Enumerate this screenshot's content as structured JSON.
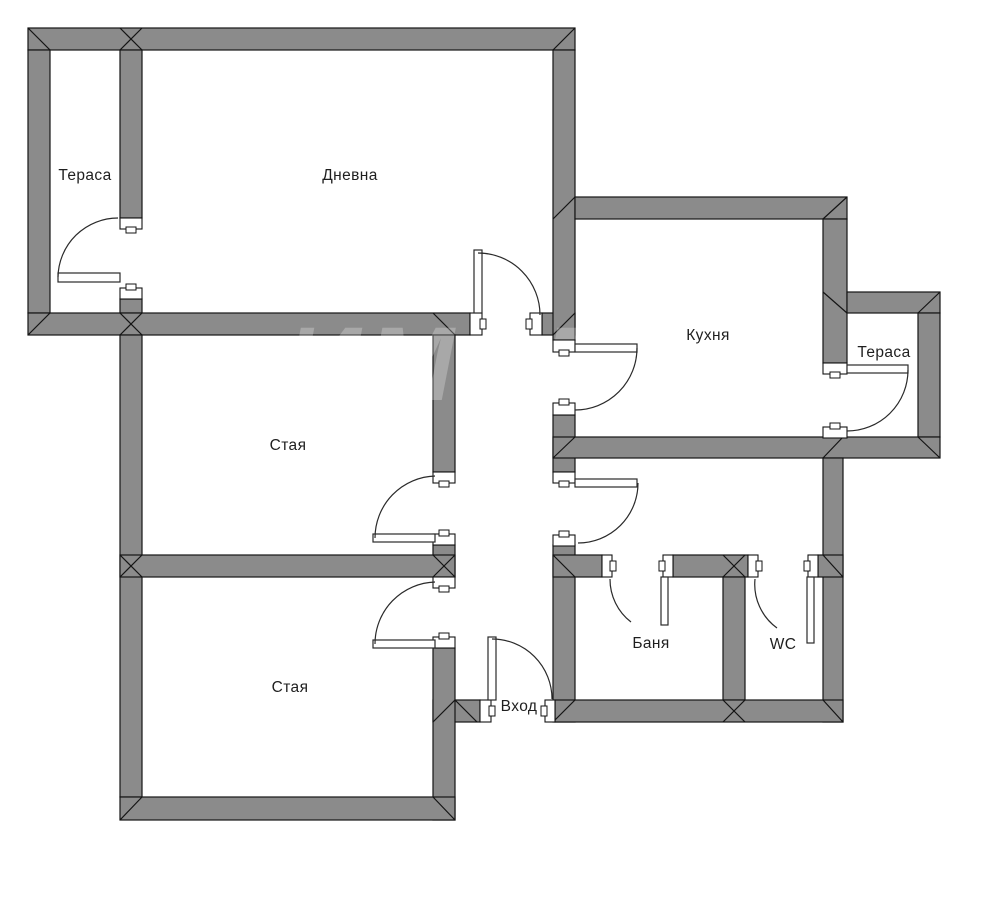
{
  "floorplan": {
    "canvas": {
      "width": 1000,
      "height": 919,
      "background": "#ffffff"
    },
    "colors": {
      "wall_fill": "#8b8b8b",
      "wall_stroke": "#141414",
      "door_stroke": "#2a2a2a",
      "opening_fill": "#ffffff",
      "label_color": "#1f1f1f",
      "watermark_color": "#ffffff"
    },
    "watermark": {
      "text": "ИМОТИ",
      "x": 285,
      "y": 400,
      "font_size": 105,
      "letter_spacing": 6,
      "opacity": 0.25
    },
    "rooms": [
      {
        "id": "terrace-top-left",
        "label": "Тераса",
        "x": 85,
        "y": 180
      },
      {
        "id": "living-room",
        "label": "Дневна",
        "x": 350,
        "y": 180
      },
      {
        "id": "kitchen",
        "label": "Кухня",
        "x": 708,
        "y": 340
      },
      {
        "id": "terrace-right",
        "label": "Тераса",
        "x": 884,
        "y": 357
      },
      {
        "id": "room-middle",
        "label": "Стая",
        "x": 288,
        "y": 450
      },
      {
        "id": "room-bottom",
        "label": "Стая",
        "x": 290,
        "y": 692
      },
      {
        "id": "bathroom",
        "label": "Баня",
        "x": 651,
        "y": 648
      },
      {
        "id": "wc",
        "label": "WC",
        "x": 783,
        "y": 649
      },
      {
        "id": "entrance",
        "label": "Вход",
        "x": 519,
        "y": 711
      }
    ],
    "walls": [
      [
        28,
        28,
        547,
        22
      ],
      [
        28,
        50,
        22,
        263
      ],
      [
        120,
        50,
        22,
        168
      ],
      [
        120,
        299,
        22,
        14
      ],
      [
        28,
        313,
        442,
        22
      ],
      [
        542,
        313,
        33,
        22
      ],
      [
        553,
        50,
        22,
        290
      ],
      [
        553,
        415,
        22,
        57
      ],
      [
        553,
        545,
        22,
        177
      ],
      [
        575,
        197,
        272,
        22
      ],
      [
        823,
        219,
        24,
        144
      ],
      [
        847,
        292,
        93,
        21
      ],
      [
        918,
        313,
        22,
        124
      ],
      [
        553,
        437,
        387,
        21
      ],
      [
        823,
        458,
        20,
        264
      ],
      [
        553,
        555,
        49,
        22
      ],
      [
        673,
        555,
        75,
        22
      ],
      [
        818,
        555,
        25,
        22
      ],
      [
        723,
        577,
        22,
        123
      ],
      [
        555,
        700,
        288,
        22
      ],
      [
        433,
        700,
        47,
        22
      ],
      [
        433,
        335,
        22,
        137
      ],
      [
        433,
        545,
        22,
        32
      ],
      [
        433,
        648,
        22,
        172
      ],
      [
        120,
        335,
        22,
        462
      ],
      [
        120,
        555,
        335,
        22
      ],
      [
        120,
        797,
        335,
        23
      ]
    ],
    "bevels": [
      [
        28,
        28,
        50,
        50
      ],
      [
        120,
        28,
        142,
        50
      ],
      [
        142,
        28,
        120,
        50
      ],
      [
        575,
        28,
        553,
        50
      ],
      [
        28,
        335,
        50,
        313
      ],
      [
        120,
        313,
        142,
        335
      ],
      [
        142,
        313,
        120,
        335
      ],
      [
        553,
        335,
        575,
        313
      ],
      [
        433,
        313,
        455,
        335
      ],
      [
        553,
        219,
        575,
        197
      ],
      [
        847,
        197,
        823,
        219
      ],
      [
        823,
        292,
        847,
        313
      ],
      [
        940,
        292,
        918,
        313
      ],
      [
        940,
        458,
        918,
        437
      ],
      [
        553,
        458,
        575,
        437
      ],
      [
        823,
        458,
        843,
        437
      ],
      [
        823,
        555,
        843,
        577
      ],
      [
        723,
        555,
        745,
        577
      ],
      [
        745,
        555,
        723,
        577
      ],
      [
        723,
        700,
        745,
        722
      ],
      [
        745,
        700,
        723,
        722
      ],
      [
        823,
        700,
        843,
        722
      ],
      [
        553,
        722,
        575,
        700
      ],
      [
        455,
        700,
        433,
        722
      ],
      [
        455,
        700,
        477,
        722
      ],
      [
        120,
        820,
        142,
        797
      ],
      [
        455,
        820,
        433,
        797
      ],
      [
        120,
        555,
        142,
        577
      ],
      [
        120,
        577,
        142,
        555
      ],
      [
        433,
        555,
        455,
        577
      ],
      [
        433,
        577,
        455,
        555
      ],
      [
        553,
        555,
        575,
        577
      ]
    ],
    "jambs": [
      [
        120,
        218,
        22,
        11,
        "S"
      ],
      [
        120,
        288,
        22,
        11,
        "N"
      ],
      [
        470,
        313,
        12,
        22,
        "E"
      ],
      [
        530,
        313,
        12,
        22,
        "W"
      ],
      [
        553,
        340,
        22,
        12,
        "S"
      ],
      [
        553,
        403,
        22,
        12,
        "N"
      ],
      [
        553,
        472,
        22,
        11,
        "S"
      ],
      [
        553,
        535,
        22,
        11,
        "N"
      ],
      [
        823,
        363,
        24,
        11,
        "S"
      ],
      [
        823,
        427,
        24,
        11,
        "N"
      ],
      [
        433,
        472,
        22,
        11,
        "S"
      ],
      [
        433,
        534,
        22,
        11,
        "N"
      ],
      [
        433,
        577,
        22,
        11,
        "S"
      ],
      [
        433,
        637,
        22,
        11,
        "N"
      ],
      [
        480,
        700,
        11,
        22,
        "E"
      ],
      [
        545,
        700,
        10,
        22,
        "W"
      ],
      [
        602,
        555,
        10,
        22,
        "E"
      ],
      [
        663,
        555,
        10,
        22,
        "W"
      ],
      [
        748,
        555,
        10,
        22,
        "E"
      ],
      [
        808,
        555,
        10,
        22,
        "W"
      ]
    ],
    "door_leaves": [
      [
        58,
        273,
        62,
        9
      ],
      [
        474,
        250,
        8,
        63
      ],
      [
        575,
        344,
        62,
        8
      ],
      [
        575,
        479,
        62,
        8
      ],
      [
        847,
        365,
        61,
        8
      ],
      [
        373,
        534,
        62,
        8
      ],
      [
        373,
        640,
        62,
        8
      ],
      [
        488,
        637,
        8,
        63
      ],
      [
        661,
        577,
        7,
        48
      ],
      [
        807,
        577,
        7,
        66
      ]
    ],
    "door_arcs": [
      "M 58 277 A 60 60 0 0 1 118 218",
      "M 478 253 A 62 62 0 0 1 540 315",
      "M 637 348 A 62 62 0 0 1 575 410",
      "M 638 483 A 60 60 0 0 1 578 543",
      "M 908 370 A 61 61 0 0 1 847 431",
      "M 375 538 A 62 62 0 0 1 435 476",
      "M 375 644 A 62 62 0 0 1 435 582",
      "M 492 639 A 60 60 0 0 1 552 699",
      "M 610 579 A 54 54 0 0 0 631 622",
      "M 755 579 A 54 54 0 0 0 777 628"
    ]
  }
}
